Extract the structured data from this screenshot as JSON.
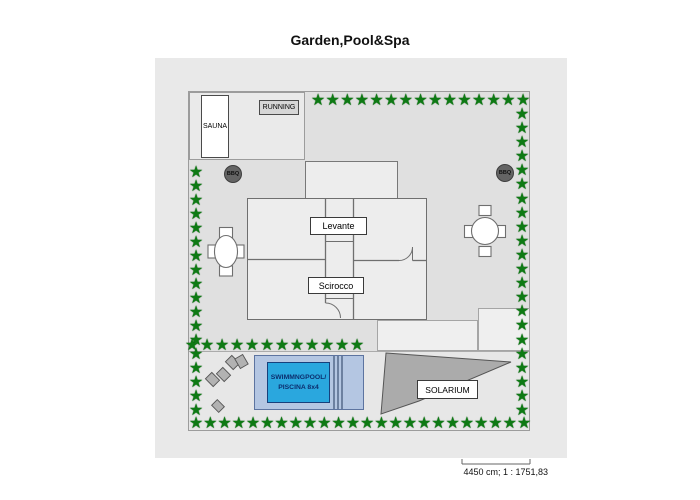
{
  "title": "Garden,Pool&Spa",
  "plan": {
    "sauna_label": "SAUNA",
    "running_label": "RUNNING",
    "bbq_left_label": "BBQ",
    "bbq_right_label": "BBQ",
    "room_levante_label": "Levante",
    "room_scirocco_label": "Scirocco",
    "pool_label_line1": "SWIMMNGPOOL/",
    "pool_label_line2": "PISCINA 8x4",
    "solarium_label": "SOLARIUM"
  },
  "footer": {
    "scale_text": "4450 cm; 1 : 1751,83"
  },
  "colors": {
    "star_green": "#0e7a14",
    "pool_water": "#2aa7de",
    "pool_deck": "#b4c6e2",
    "solarium_gray": "#ababab"
  },
  "stars": {
    "glyph": "★",
    "rows": [
      {
        "name": "top-border",
        "orient": "h",
        "fixed": 100,
        "from": 318,
        "to": 523,
        "count": 15
      },
      {
        "name": "right-border",
        "orient": "v",
        "fixed": 522,
        "from": 114,
        "to": 410,
        "count": 22
      },
      {
        "name": "bottom-border",
        "orient": "h",
        "fixed": 423,
        "from": 196,
        "to": 524,
        "count": 24
      },
      {
        "name": "left-border",
        "orient": "v",
        "fixed": 196,
        "from": 172,
        "to": 410,
        "count": 18
      },
      {
        "name": "inner-hedge",
        "orient": "h",
        "fixed": 345,
        "from": 192,
        "to": 357,
        "count": 12
      }
    ]
  }
}
